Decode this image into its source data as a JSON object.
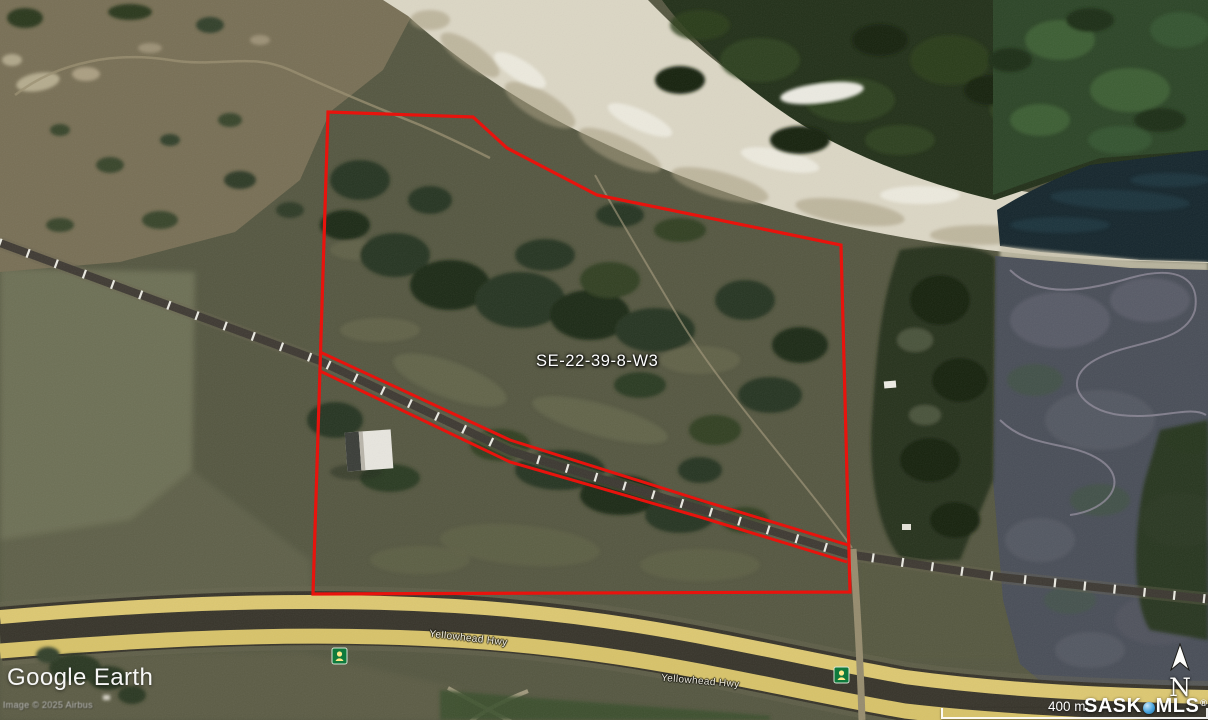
{
  "map": {
    "parcel_label": "SE-22-39-8-W3",
    "highway_labels": [
      "Yellowhead Hwy",
      "Yellowhead Hwy"
    ],
    "geometry": {
      "parcel_outline": [
        [
          328,
          112
        ],
        [
          473,
          117
        ],
        [
          507,
          148
        ],
        [
          597,
          195
        ],
        [
          841,
          245
        ],
        [
          850,
          592
        ],
        [
          313,
          594
        ]
      ],
      "rail_corridor_upper": [
        [
          320,
          352
        ],
        [
          510,
          440
        ],
        [
          700,
          500
        ],
        [
          848,
          545
        ]
      ],
      "rail_corridor_lower": [
        [
          320,
          371
        ],
        [
          510,
          462
        ],
        [
          700,
          517
        ],
        [
          847,
          562
        ]
      ],
      "railway": [
        [
          0,
          243
        ],
        [
          160,
          302
        ],
        [
          320,
          361
        ],
        [
          510,
          451
        ],
        [
          700,
          509
        ],
        [
          847,
          554
        ],
        [
          1000,
          577
        ],
        [
          1208,
          599
        ]
      ]
    }
  },
  "branding": {
    "logo": "Google Earth",
    "copyright": "Image © 2025 Airbus"
  },
  "scale": {
    "label": "400 m"
  },
  "watermark": {
    "sask": "SASK",
    "mls": "MLS",
    "registered": "®"
  },
  "compass": {
    "north_label": "N"
  },
  "icons": [
    "yellowhead-hwy-16-shield-icon",
    "north-arrow-icon",
    "mls-dot-icon"
  ],
  "colors": {
    "parcel_outline_red": "#e8130d",
    "highway_shield_green": "#0f7a3c",
    "mls_dot_blue": "#47a3dd",
    "river_water": "#15262d",
    "river_gravel": "#dcd7c5",
    "slate_field": "#494e58",
    "highway_yellow": "#ddc871"
  }
}
